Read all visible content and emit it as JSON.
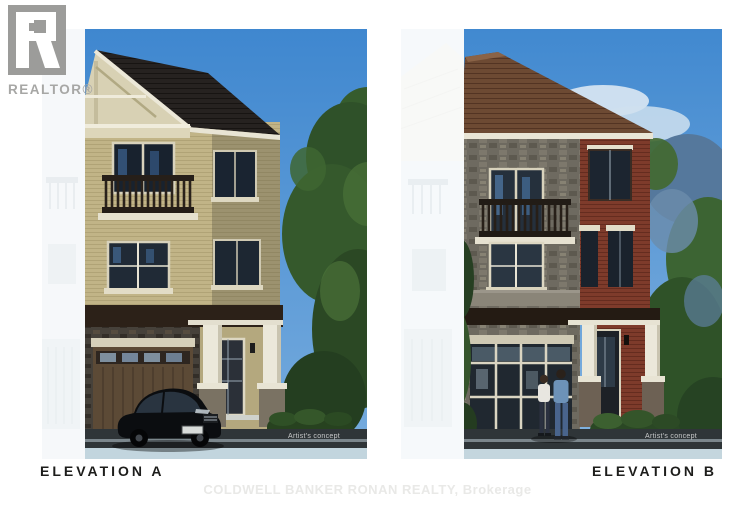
{
  "page": {
    "background_color": "#ffffff"
  },
  "realtor_watermark": {
    "text": "REALTOR®"
  },
  "brokerage_watermark": {
    "text": "COLDWELL BANKER RONAN REALTY, Brokerage"
  },
  "panels": [
    {
      "label": "ELEVATION A",
      "artist_note": "Artist's concept"
    },
    {
      "label": "ELEVATION B",
      "artist_note": "Artist's concept"
    }
  ],
  "colors": {
    "sky": "#4a8ed2",
    "roof_a": "#262220",
    "brick_a": "#c1b487",
    "trim_cream": "#e8e4d4",
    "roof_b": "#6d4a33",
    "stone_b": "#6e6a60",
    "brick_b": "#7e3b2b",
    "road": "#2f3538",
    "label_text": "#1d1d1b",
    "watermark_gray": "#9c9c9a"
  }
}
